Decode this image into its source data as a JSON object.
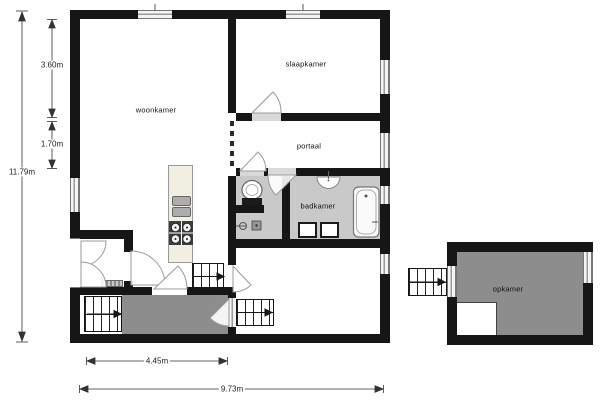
{
  "plan": {
    "rooms": {
      "woonkamer": {
        "label": "woonkamer"
      },
      "slaapkamer": {
        "label": "slaapkamer"
      },
      "portaal": {
        "label": "portaal"
      },
      "badkamer": {
        "label": "badkamer"
      },
      "opkamer": {
        "label": "opkamer"
      }
    },
    "dimensions": {
      "total_height_left": "11.79m",
      "upper_left_segment": "3.60m",
      "lower_left_segment": "1.70m",
      "terrace_width": "4.45m",
      "total_width_bottom": "9.73m"
    },
    "fixtures": [
      "bathtub",
      "toilet",
      "washbasin",
      "wall-sink",
      "kitchen-counter",
      "kitchen-sink",
      "stove",
      "stairs-exterior-left",
      "stairs-interior",
      "stairs-exterior-right",
      "stairs-opkamer",
      "doormat",
      "terrace",
      "cabinets",
      "double-entry-doors"
    ],
    "colors": {
      "wall": "#161616",
      "bathroom_floor": "#c9c9c9",
      "terrace_floor": "#8d8d8d",
      "opkamer_floor": "#8d8d8d",
      "kitchen_counter": "#f1efe2",
      "window": "#f4f4f4",
      "dimension_line": "#333333",
      "background": "#ffffff"
    }
  }
}
